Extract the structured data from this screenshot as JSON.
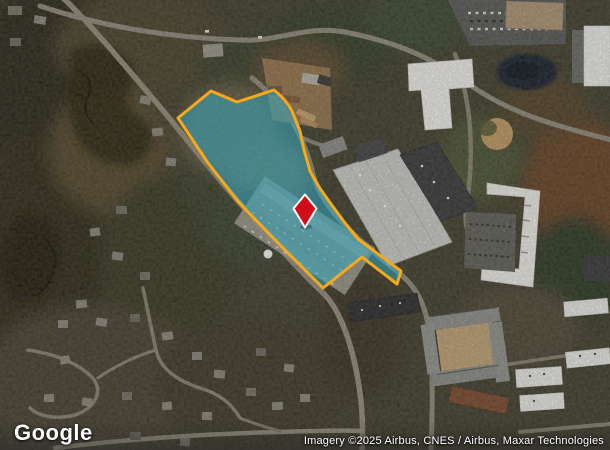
{
  "map": {
    "logo": "Google",
    "attribution": "Imagery ©2025 Airbus, CNES / Airbus, Maxar Technologies"
  },
  "overlay": {
    "parcel_fill": "#2fa8c4",
    "parcel_stroke": "#f7a81b",
    "marker_fill": "#d30d18",
    "marker_stroke": "#ffffff"
  }
}
